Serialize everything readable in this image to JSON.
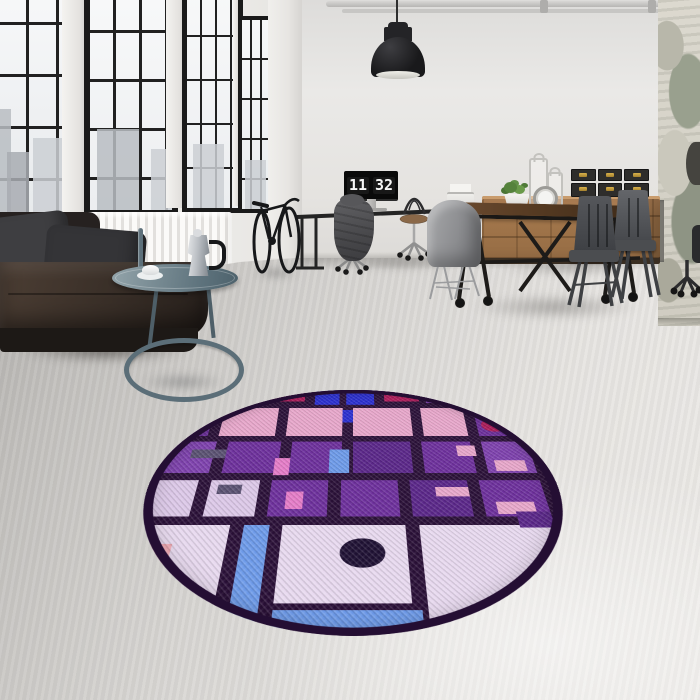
{
  "scene": {
    "clock": {
      "hours": "11",
      "minutes": "32"
    }
  },
  "palette": {
    "wall": "#e7e5e2",
    "floor_light": "#edebe8",
    "floor_dark": "#a3a19e",
    "window_frame": "#1a1a1a",
    "sofa_leather": "#382e27",
    "radiator": "#f6f5f3",
    "lamp": "#19191b",
    "wood_sideboard": "#a2764b",
    "table_wood": "#553a22",
    "metal_chair": "#4b4d50",
    "side_table_metal": "#5d707a",
    "box_brass": "#c9a23a"
  },
  "rug": {
    "background": "#2a1038",
    "border": "#240e33",
    "palette": {
      "pu": "#6d2f9c",
      "pd": "#5a2689",
      "pl": "#7e41ae",
      "pk": "#e8a7cb",
      "pb": "#e57cc8",
      "ll": "#e8d9ef",
      "l2": "#dcc8e8",
      "bl": "#2a2ed0",
      "cf": "#6d9ae9",
      "cr": "#b41d5e",
      "vi": "#9a4fd0",
      "sl": "#5a5172",
      "sa": "#f2abb5",
      "nv": "#1f1134"
    },
    "cells": [
      [
        2,
        0,
        9,
        8,
        "pu"
      ],
      [
        13,
        0,
        11,
        8,
        "pb"
      ],
      [
        26,
        1,
        10,
        6,
        "cr"
      ],
      [
        39,
        0,
        7,
        9,
        "bl"
      ],
      [
        48,
        0,
        8,
        9,
        "bl"
      ],
      [
        59,
        1,
        10,
        6,
        "cr"
      ],
      [
        71,
        0,
        9,
        8,
        "pl"
      ],
      [
        83,
        0,
        13,
        9,
        "pu"
      ],
      [
        40,
        11,
        4,
        6,
        "vi"
      ],
      [
        46,
        12,
        4,
        7,
        "bl"
      ],
      [
        2,
        11,
        9,
        15,
        "pu"
      ],
      [
        14,
        11,
        15,
        15,
        "pk"
      ],
      [
        32,
        11,
        15,
        15,
        "pk"
      ],
      [
        50,
        11,
        16,
        15,
        "pk"
      ],
      [
        69,
        11,
        12,
        15,
        "pk"
      ],
      [
        84,
        11,
        12,
        15,
        "pu"
      ],
      [
        85,
        17,
        7,
        7,
        "cr",
        "c"
      ],
      [
        2,
        29,
        12,
        15,
        "pl"
      ],
      [
        17,
        29,
        14,
        15,
        "pu"
      ],
      [
        34,
        29,
        13,
        15,
        "pu"
      ],
      [
        50,
        29,
        15,
        15,
        "pd"
      ],
      [
        68,
        29,
        13,
        15,
        "pu"
      ],
      [
        84,
        29,
        12,
        15,
        "pl"
      ],
      [
        8,
        33,
        9,
        4,
        "sl"
      ],
      [
        30,
        37,
        4,
        8,
        "pb"
      ],
      [
        44,
        33,
        5,
        11,
        "cf"
      ],
      [
        77,
        31,
        5,
        5,
        "pk"
      ],
      [
        86,
        38,
        8,
        5,
        "pk"
      ],
      [
        2,
        47,
        10,
        15,
        "l2"
      ],
      [
        15,
        47,
        12,
        15,
        "l2"
      ],
      [
        30,
        47,
        14,
        15,
        "pu"
      ],
      [
        47,
        47,
        14,
        15,
        "pu"
      ],
      [
        64,
        47,
        14,
        15,
        "pd"
      ],
      [
        81,
        47,
        15,
        15,
        "pu"
      ],
      [
        17,
        49,
        6,
        4,
        "sl"
      ],
      [
        34,
        52,
        4,
        7,
        "pb"
      ],
      [
        70,
        50,
        8,
        4,
        "pk"
      ],
      [
        84,
        56,
        9,
        5,
        "pk"
      ],
      [
        2,
        65,
        20,
        26,
        "ll"
      ],
      [
        25,
        65,
        6,
        31,
        "cf"
      ],
      [
        34,
        65,
        28,
        26,
        "ll"
      ],
      [
        65,
        65,
        31,
        31,
        "ll"
      ],
      [
        47,
        70,
        10,
        10,
        "nv",
        "c"
      ],
      [
        34,
        93,
        30,
        5,
        "cf"
      ],
      [
        5,
        72,
        5,
        7,
        "sa"
      ],
      [
        88,
        60,
        8,
        6,
        "pd"
      ]
    ]
  }
}
